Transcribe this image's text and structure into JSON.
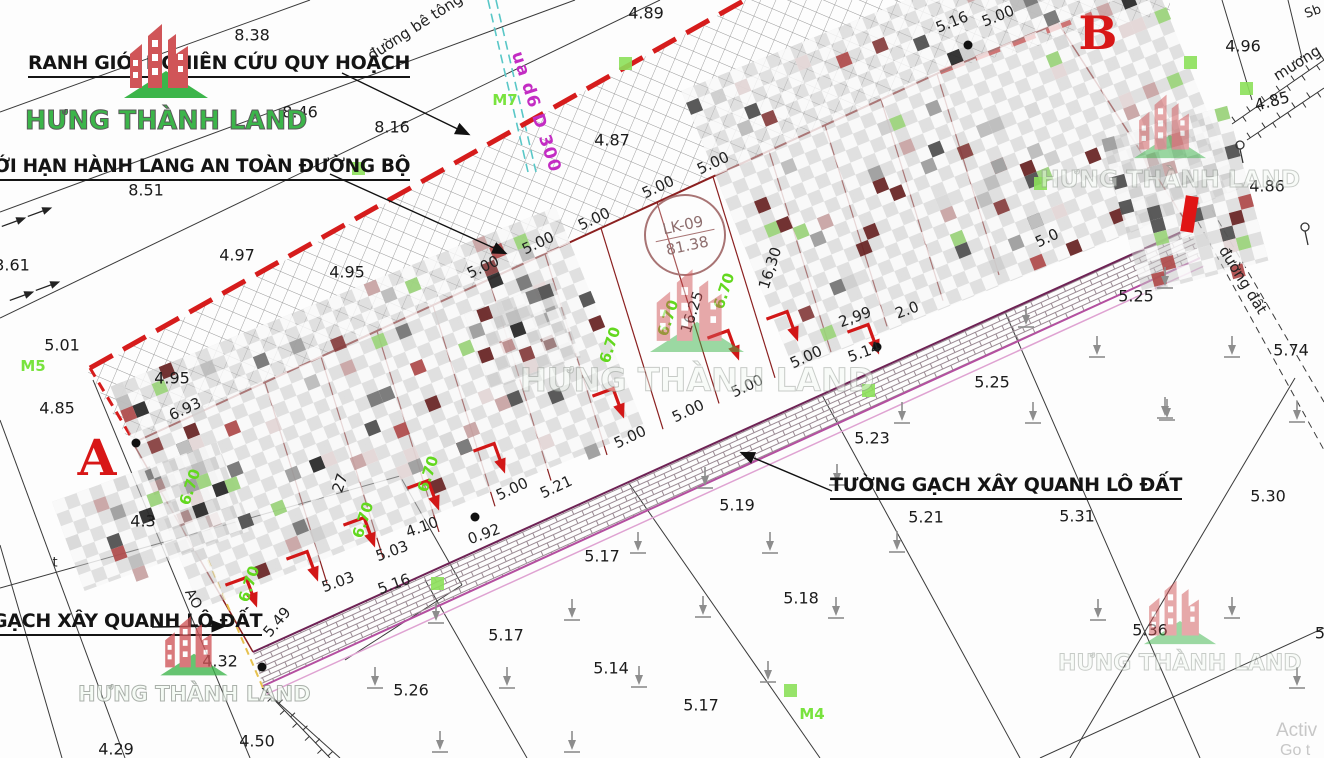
{
  "canvas": {
    "width": 1324,
    "height": 758
  },
  "brand": {
    "name": "HƯNG THÀNH LAND"
  },
  "annotations": {
    "ranh_gioi": {
      "text": "RANH GIỚI NGHIÊN CỨU QUY HOẠCH"
    },
    "gioi_han": {
      "text": "ỚI HẠN HÀNH LANG AN TOÀN ĐƯỜNG BỘ"
    },
    "tuong_gach": {
      "text": "TƯỜNG GẠCH XÂY QUANH LÔ ĐẤT"
    },
    "gach_xay": {
      "text": "GẠCH XÂY QUANH LÔ ĐẤT"
    }
  },
  "section_letters": [
    {
      "text": "A",
      "x": 97,
      "y": 458,
      "size": 50
    },
    {
      "text": "B",
      "x": 1098,
      "y": 33,
      "size": 46
    }
  ],
  "lot_stamp": {
    "code": "LK-09",
    "area": "81.38"
  },
  "road_labels": [
    {
      "text": "đường bê tông",
      "x": 415,
      "y": 27,
      "rot": -33,
      "size": 15
    },
    {
      "text": "ua d6 D 300",
      "x": 536,
      "y": 112,
      "rot": 72,
      "size": 17,
      "magenta": true
    },
    {
      "text": "mương",
      "x": 1297,
      "y": 63,
      "rot": -32,
      "size": 15
    },
    {
      "text": "Sb",
      "x": 1313,
      "y": 12,
      "rot": -20,
      "size": 13
    },
    {
      "text": "đường đất",
      "x": 1243,
      "y": 280,
      "rot": 58,
      "size": 15
    },
    {
      "text": "AO",
      "x": 193,
      "y": 599,
      "rot": 62,
      "size": 14
    },
    {
      "text": "t",
      "x": 55,
      "y": 563,
      "rot": 0,
      "size": 13
    }
  ],
  "survey_markers": {
    "labels": [
      {
        "text": "M7",
        "x": 505,
        "y": 100
      },
      {
        "text": "M5",
        "x": 33,
        "y": 366
      },
      {
        "text": "M4",
        "x": 812,
        "y": 714
      }
    ],
    "squares": [
      [
        625,
        63
      ],
      [
        358,
        168
      ],
      [
        1040,
        183
      ],
      [
        1246,
        88
      ],
      [
        1190,
        62
      ],
      [
        868,
        390
      ],
      [
        437,
        583
      ],
      [
        790,
        690
      ]
    ]
  },
  "elevations": [
    [
      "8.38",
      252,
      35
    ],
    [
      "4.89",
      646,
      13
    ],
    [
      "4.96",
      1243,
      46
    ],
    [
      "8.46",
      300,
      112
    ],
    [
      "8.16",
      392,
      127
    ],
    [
      "4.87",
      612,
      140
    ],
    [
      "4.85",
      1272,
      101,
      -15
    ],
    [
      "4.86",
      1267,
      186
    ],
    [
      "8.51",
      146,
      190
    ],
    [
      "3.61",
      12,
      265
    ],
    [
      "4.97",
      237,
      255
    ],
    [
      "4.95",
      347,
      272
    ],
    [
      "5.25",
      1136,
      296
    ],
    [
      "5.01",
      62,
      345
    ],
    [
      "5.74",
      1291,
      350
    ],
    [
      "4.95",
      172,
      378
    ],
    [
      "4.85",
      57,
      408
    ],
    [
      "5.25",
      992,
      382
    ],
    [
      "5.23",
      872,
      438
    ],
    [
      "5.19",
      737,
      505
    ],
    [
      "5.30",
      1268,
      496
    ],
    [
      "5.31",
      1077,
      516
    ],
    [
      "5.21",
      926,
      517
    ],
    [
      "5.17",
      602,
      556
    ],
    [
      "5.18",
      801,
      598
    ],
    [
      "5.36",
      1150,
      630
    ],
    [
      "5.17",
      506,
      635
    ],
    [
      "5.14",
      611,
      668
    ],
    [
      "5.26",
      411,
      690
    ],
    [
      "5.17",
      701,
      705
    ],
    [
      "4.50",
      257,
      741
    ],
    [
      "4.29",
      116,
      749
    ],
    [
      "4.32",
      220,
      661
    ],
    [
      "4.3",
      143,
      521
    ],
    [
      "5",
      1320,
      633
    ]
  ],
  "dimensions": [
    [
      "6.93",
      185,
      409,
      -25
    ],
    [
      "16.25",
      692,
      312,
      -72
    ],
    [
      "16,30",
      770,
      268,
      -72
    ],
    [
      "2,99",
      855,
      317,
      -20
    ],
    [
      "2.0",
      907,
      310,
      -20
    ],
    [
      "5.14",
      864,
      352,
      -20
    ],
    [
      "5.00",
      483,
      267,
      -25
    ],
    [
      "5.00",
      538,
      243,
      -25
    ],
    [
      "5.00",
      594,
      219,
      -25
    ],
    [
      "5.00",
      658,
      187,
      -25
    ],
    [
      "5.00",
      713,
      163,
      -25
    ],
    [
      "5.16",
      952,
      22,
      -22
    ],
    [
      "5.00",
      998,
      16,
      -22
    ],
    [
      "5.0",
      1047,
      238,
      -25
    ],
    [
      "5.00",
      512,
      489,
      -25
    ],
    [
      "5.21",
      556,
      487,
      -25
    ],
    [
      "5.00",
      630,
      437,
      -25
    ],
    [
      "5.00",
      688,
      411,
      -25
    ],
    [
      "5.00",
      747,
      386,
      -25
    ],
    [
      "5.00",
      806,
      357,
      -25
    ],
    [
      "0.92",
      484,
      534,
      -20
    ],
    [
      "4.10",
      422,
      527,
      -20
    ],
    [
      "5.03",
      392,
      551,
      -20
    ],
    [
      "5.03",
      338,
      582,
      -20
    ],
    [
      "5.16",
      394,
      584,
      -20
    ],
    [
      "5.49",
      277,
      622,
      -50
    ],
    [
      "27",
      340,
      483,
      -72
    ]
  ],
  "green_dimension": "6.70",
  "green_dimension_positions": [
    [
      190,
      487
    ],
    [
      249,
      584
    ],
    [
      363,
      520
    ],
    [
      428,
      474
    ],
    [
      610,
      345
    ],
    [
      668,
      318
    ],
    [
      724,
      291
    ]
  ],
  "os_overlay": {
    "line1": "Activ",
    "line2": "Go t"
  }
}
